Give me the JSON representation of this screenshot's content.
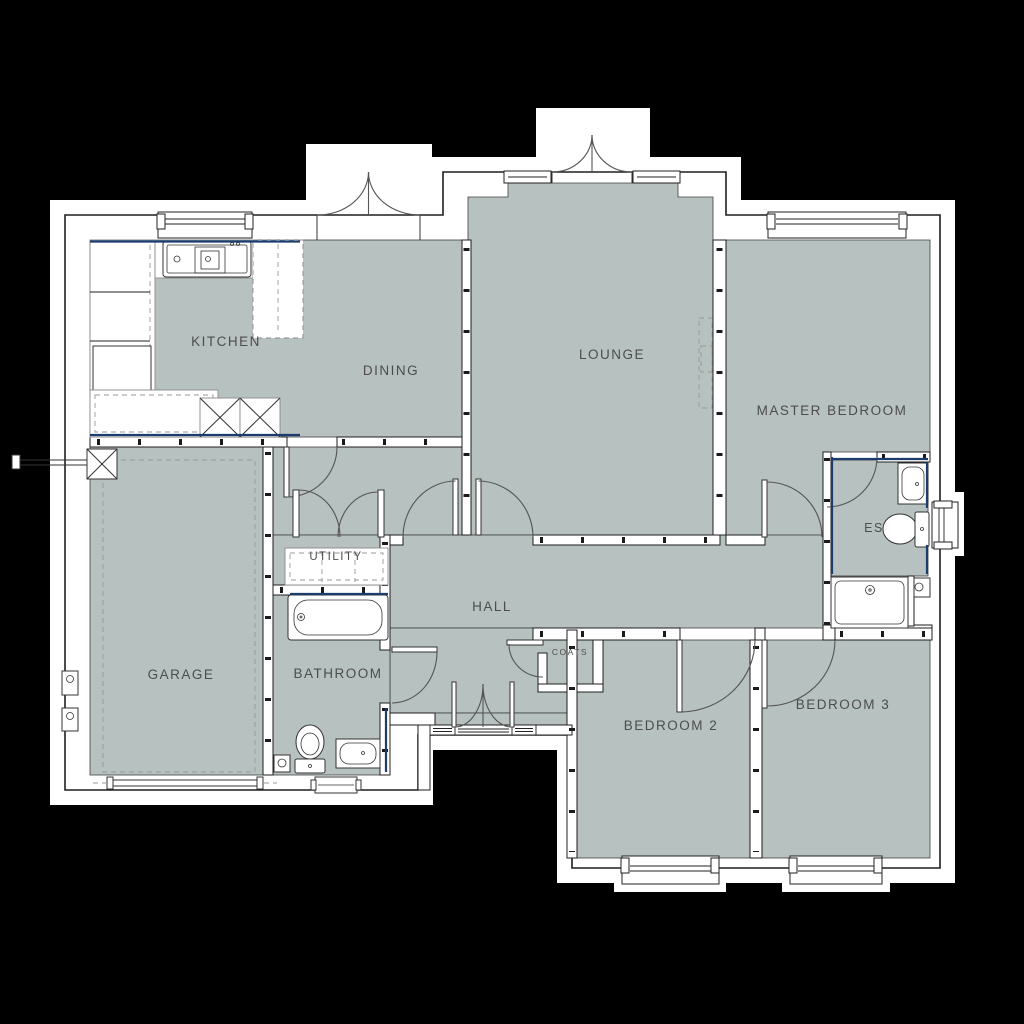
{
  "plan": {
    "type": "architectural-floor-plan",
    "rooms": {
      "kitchen": {
        "label": "KITCHEN"
      },
      "dining": {
        "label": "DINING"
      },
      "lounge": {
        "label": "LOUNGE"
      },
      "master_bedroom": {
        "label": "MASTER BEDROOM"
      },
      "ensuite": {
        "label": "ES"
      },
      "utility": {
        "label": "UTILITY"
      },
      "hall": {
        "label": "HALL"
      },
      "coats": {
        "label": "COATS"
      },
      "garage": {
        "label": "GARAGE"
      },
      "bathroom": {
        "label": "BATHROOM"
      },
      "bedroom2": {
        "label": "BEDROOM 2"
      },
      "bedroom3": {
        "label": "BEDROOM 3"
      }
    },
    "colors": {
      "background": "#000000",
      "page": "#ffffff",
      "floor": "#b6c1c0",
      "wall_fill": "#ffffff",
      "outline": "#1f1f1f",
      "label_text": "#4d4d4d",
      "accent_blue": "#1c3c6e",
      "detail_gray": "#999999"
    },
    "fixtures": [
      "kitchen-sink",
      "kitchen-units",
      "appliance-space",
      "bathtub",
      "toilet",
      "wash-basin",
      "shower-tray",
      "radiator",
      "utility-counter",
      "garage-flue",
      "meter-box",
      "chimney-recess"
    ]
  }
}
